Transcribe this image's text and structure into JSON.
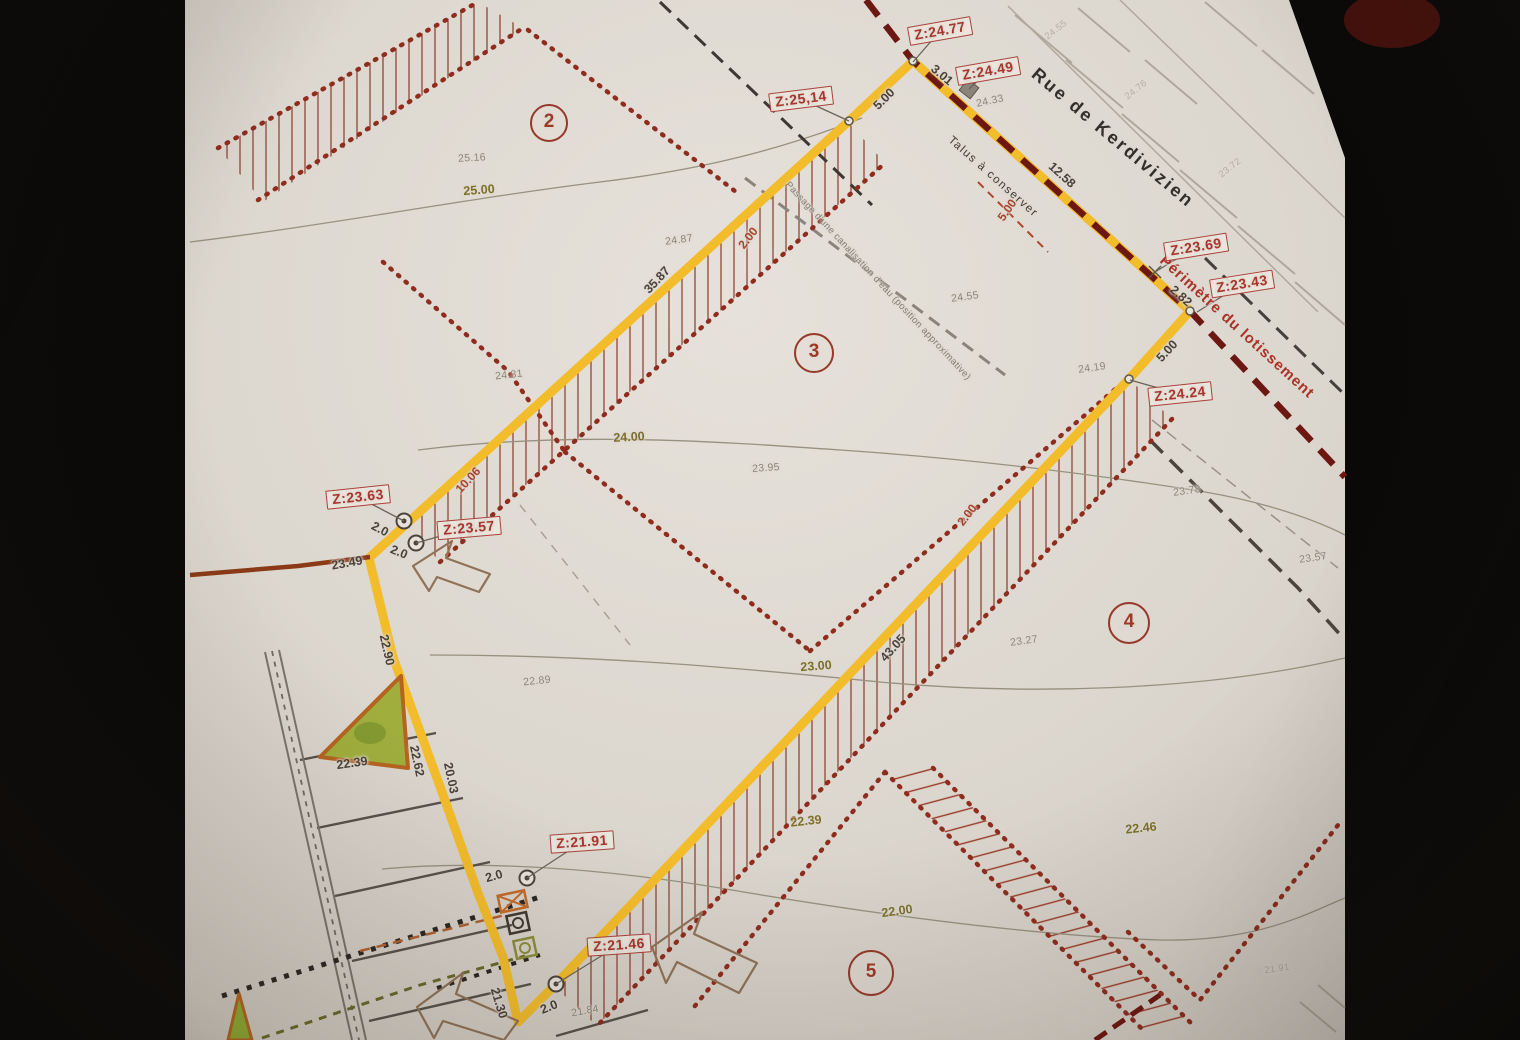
{
  "colors": {
    "paper": "#dcd7cf",
    "yellow": "#f3bc2b",
    "maroon": "#6d1712",
    "reddot": "#8f2c1e",
    "redlabel": "#a8352c",
    "olive": "#7d6f2a",
    "graylabel": "#8d8679",
    "ink": "#4a4138"
  },
  "street": {
    "name": "Rue de Kerdivizien"
  },
  "labels_static": {
    "perimeter": "Périmètre du lotissement",
    "talus": "Talus à conserver",
    "passage": "Passage d'une canalisation d'eau (position approximative)"
  },
  "lot_numbers": [
    {
      "num": "2",
      "x": 549,
      "y": 123,
      "d": 34
    },
    {
      "num": "3",
      "x": 814,
      "y": 353,
      "d": 36
    },
    {
      "num": "4",
      "x": 1129,
      "y": 623,
      "d": 38
    },
    {
      "num": "5",
      "x": 871,
      "y": 973,
      "d": 42
    }
  ],
  "z_markers": [
    {
      "label": "Z:24.77",
      "x": 940,
      "y": 31,
      "rot": -10,
      "px": 913,
      "py": 62
    },
    {
      "label": "Z:24.49",
      "x": 988,
      "y": 71,
      "rot": -10,
      "px": 969,
      "py": 89
    },
    {
      "label": "Z:25,14",
      "x": 801,
      "y": 99,
      "rot": -7,
      "px": 849,
      "py": 121
    },
    {
      "label": "Z:23.69",
      "x": 1196,
      "y": 247,
      "rot": -9,
      "px": 1155,
      "py": 272
    },
    {
      "label": "Z:23.43",
      "x": 1242,
      "y": 284,
      "rot": -9,
      "px": 1197,
      "py": 312
    },
    {
      "label": "Z:24.24",
      "x": 1180,
      "y": 394,
      "rot": -6,
      "px": 1130,
      "py": 380
    },
    {
      "label": "Z:23.63",
      "x": 358,
      "y": 497,
      "rot": -6,
      "px": 404,
      "py": 521
    },
    {
      "label": "Z:23.57",
      "x": 469,
      "y": 528,
      "rot": -5,
      "px": 416,
      "py": 543
    },
    {
      "label": "Z:21.91",
      "x": 582,
      "y": 842,
      "rot": -4,
      "px": 527,
      "py": 878
    },
    {
      "label": "Z:21.46",
      "x": 619,
      "y": 945,
      "rot": -4,
      "px": 556,
      "py": 984
    }
  ],
  "dim_labels": [
    {
      "t": "3.01",
      "x": 942,
      "y": 75,
      "r": 40
    },
    {
      "t": "12.58",
      "x": 1062,
      "y": 175,
      "r": 42
    },
    {
      "t": "2.82",
      "x": 1181,
      "y": 296,
      "r": 42
    },
    {
      "t": "5.00",
      "x": 884,
      "y": 99,
      "r": -45
    },
    {
      "t": "5.00",
      "x": 1167,
      "y": 351,
      "r": -47
    },
    {
      "t": "35.87",
      "x": 657,
      "y": 280,
      "r": -47
    },
    {
      "t": "43.05",
      "x": 893,
      "y": 648,
      "r": -48
    },
    {
      "t": "22.90",
      "x": 387,
      "y": 650,
      "r": 77
    },
    {
      "t": "22.62",
      "x": 417,
      "y": 761,
      "r": 78
    },
    {
      "t": "20.03",
      "x": 451,
      "y": 778,
      "r": 78
    },
    {
      "t": "21.30",
      "x": 499,
      "y": 1003,
      "r": 73
    },
    {
      "t": "2.0",
      "x": 380,
      "y": 529,
      "r": 28
    },
    {
      "t": "2.0",
      "x": 399,
      "y": 552,
      "r": 22
    },
    {
      "t": "2.0",
      "x": 494,
      "y": 876,
      "r": -16
    },
    {
      "t": "2.0",
      "x": 549,
      "y": 1007,
      "r": -22
    },
    {
      "t": "23.49",
      "x": 347,
      "y": 563,
      "r": -10
    },
    {
      "t": "22.39",
      "x": 352,
      "y": 763,
      "r": -8
    }
  ],
  "dim_labels_red": [
    {
      "t": "5.00",
      "x": 1007,
      "y": 210,
      "r": -55
    },
    {
      "t": "10.06",
      "x": 468,
      "y": 480,
      "r": -47
    },
    {
      "t": "2.00",
      "x": 748,
      "y": 238,
      "r": -52
    },
    {
      "t": "2.00",
      "x": 967,
      "y": 515,
      "r": -52
    }
  ],
  "contour_labels": [
    {
      "t": "25.00",
      "x": 479,
      "y": 190,
      "r": -4
    },
    {
      "t": "24.00",
      "x": 629,
      "y": 437,
      "r": -3
    },
    {
      "t": "23.00",
      "x": 816,
      "y": 666,
      "r": -4
    },
    {
      "t": "22.00",
      "x": 897,
      "y": 911,
      "r": -8
    },
    {
      "t": "22.39",
      "x": 806,
      "y": 821,
      "r": -6
    },
    {
      "t": "22.46",
      "x": 1141,
      "y": 828,
      "r": -6
    }
  ],
  "spot_elevations": [
    {
      "t": "25.16",
      "x": 472,
      "y": 158,
      "r": -3
    },
    {
      "t": "24.87",
      "x": 679,
      "y": 240,
      "r": -8
    },
    {
      "t": "24.31",
      "x": 509,
      "y": 375,
      "r": -6
    },
    {
      "t": "23.95",
      "x": 766,
      "y": 468,
      "r": -4
    },
    {
      "t": "24.55",
      "x": 965,
      "y": 297,
      "r": -8
    },
    {
      "t": "24.33",
      "x": 990,
      "y": 101,
      "r": -12
    },
    {
      "t": "24.19",
      "x": 1092,
      "y": 368,
      "r": -8
    },
    {
      "t": "23.27",
      "x": 1024,
      "y": 641,
      "r": -8
    },
    {
      "t": "23.78",
      "x": 1187,
      "y": 491,
      "r": -8
    },
    {
      "t": "23.57",
      "x": 1313,
      "y": 558,
      "r": -8
    },
    {
      "t": "22.89",
      "x": 537,
      "y": 681,
      "r": -6
    },
    {
      "t": "21.84",
      "x": 585,
      "y": 1011,
      "r": -10
    },
    {
      "t": "21.91",
      "x": 1277,
      "y": 969,
      "r": -8,
      "faint": true
    },
    {
      "t": "24.55",
      "x": 1056,
      "y": 30,
      "r": -38,
      "faint": true
    },
    {
      "t": "24.76",
      "x": 1136,
      "y": 90,
      "r": -38,
      "faint": true
    },
    {
      "t": "23.72",
      "x": 1230,
      "y": 168,
      "r": -38,
      "faint": true
    }
  ]
}
